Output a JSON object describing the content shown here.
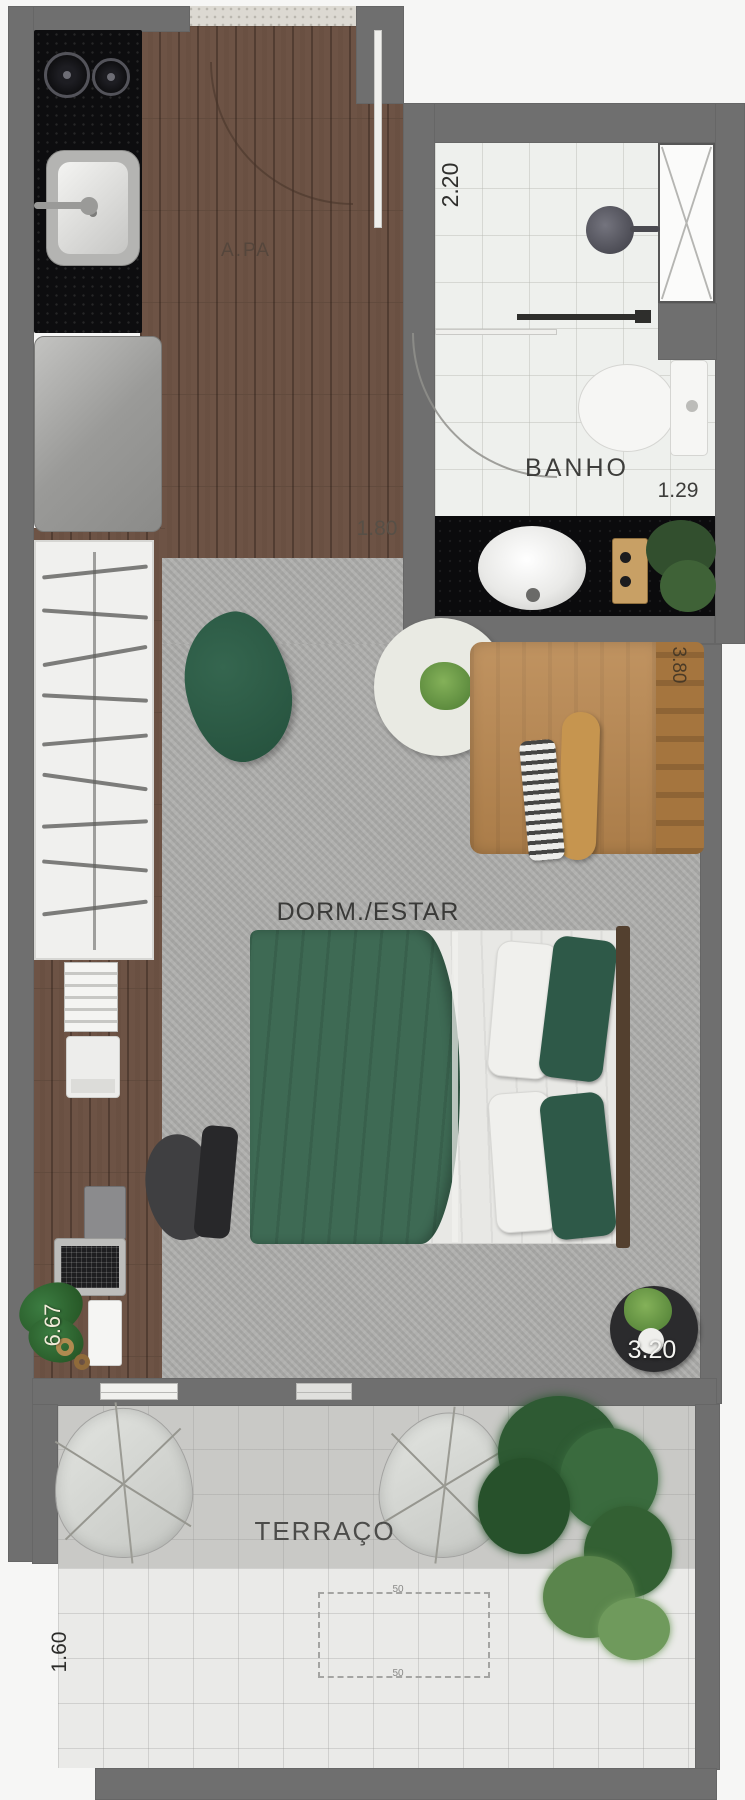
{
  "floorplan": {
    "rooms": [
      {
        "id": "apa",
        "label": "A.PA"
      },
      {
        "id": "banho",
        "label": "BANHO"
      },
      {
        "id": "dorm-estar",
        "label": "DORM./ESTAR"
      },
      {
        "id": "terraco",
        "label": "TERRAÇO"
      }
    ],
    "dimensions": {
      "shower_width": "2.20",
      "banho_width": "1.29",
      "apa_width": "1.80",
      "living_depth": "3.80",
      "unit_length": "6.67",
      "room_width": "3.20",
      "terrace_depth": "1.60",
      "detail_top": "50",
      "detail_bottom": "50"
    },
    "colors": {
      "wall": "#6f6f6f",
      "wood_floor": "#6d5345",
      "carpet": "#ababa9",
      "kitchen_counter": "#0d0d0f",
      "sofa": "#b9874f",
      "bed_green": "#3e6a54",
      "pillow_green": "#2e5948",
      "bath_tile": "#eef0ed",
      "terrace_floor": "#c9c9c6",
      "plant_green": "#2e5a33",
      "label_dark": "#3a3a38",
      "label_light": "#f4f4f1"
    }
  }
}
